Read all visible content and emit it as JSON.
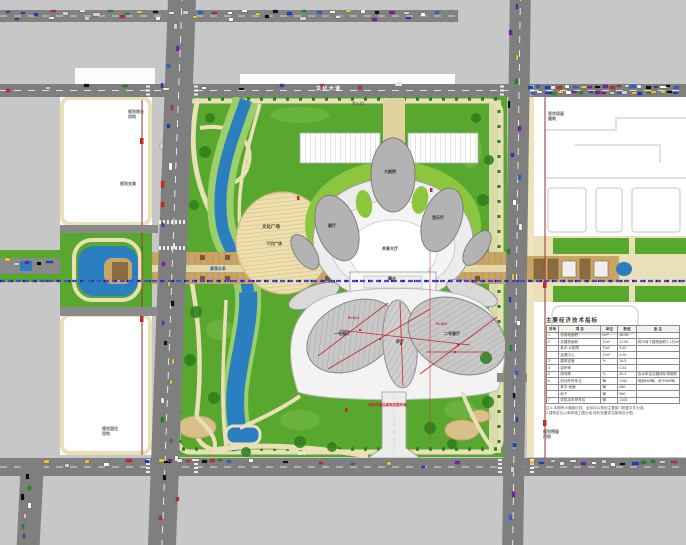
{
  "meta": {
    "drawing_type": "规划总平面图"
  },
  "colors": {
    "background_gray": "#c7c7c7",
    "road_gray": "#7f7f7f",
    "park_green": "#58a82f",
    "bank_green": "#9ccf6a",
    "water_blue": "#2b7fc0",
    "path_cream": "#e9e0b8",
    "axis_tan": "#c9a467",
    "building_gray": "#b3b3b3",
    "dimension_red": "#c62828",
    "boundary_brown": "#8b3a2a",
    "planning_line_purple": "#4747cf"
  },
  "labels": [
    {
      "id": "top-road-name",
      "text": "文 化 大 道",
      "x": 316,
      "y": 87,
      "size": 5,
      "color": "#ffffff"
    },
    {
      "id": "plot-nw-label",
      "text": "规划商业\n用地",
      "x": 128,
      "y": 110,
      "size": 4,
      "color": "#666666"
    },
    {
      "id": "road-branch-label",
      "text": "规划支路",
      "x": 120,
      "y": 182,
      "size": 4,
      "color": "#666666"
    },
    {
      "id": "plot-sw-label",
      "text": "规划居住\n用地",
      "x": 102,
      "y": 427,
      "size": 4,
      "color": "#666666"
    },
    {
      "id": "plot-ne-label",
      "text": "现状保留\n建筑",
      "x": 548,
      "y": 112,
      "size": 4,
      "color": "#666666"
    },
    {
      "id": "plot-se-label",
      "text": "规划预留\n用地",
      "x": 543,
      "y": 430,
      "size": 4,
      "color": "#666666"
    },
    {
      "id": "river-label",
      "text": "景观水系",
      "x": 210,
      "y": 267,
      "size": 4,
      "color": "#1a5fa8"
    },
    {
      "id": "plaza-label",
      "text": "文化广场",
      "x": 262,
      "y": 224,
      "size": 4.5,
      "color": "#44412e"
    },
    {
      "id": "sunken-plaza-label",
      "text": "下沉广场",
      "x": 266,
      "y": 242,
      "size": 4,
      "color": "#44412e"
    },
    {
      "id": "hall-exhibition-label",
      "text": "展厅",
      "x": 328,
      "y": 224,
      "size": 4,
      "color": "#333333"
    },
    {
      "id": "grand-theater-label",
      "text": "大剧院",
      "x": 384,
      "y": 170,
      "size": 4,
      "color": "#333333"
    },
    {
      "id": "concert-hall-label",
      "text": "音乐厅",
      "x": 432,
      "y": 216,
      "size": 4,
      "color": "#333333"
    },
    {
      "id": "shared-hall-label",
      "text": "共享大厅",
      "x": 382,
      "y": 247,
      "size": 4,
      "color": "#333333"
    },
    {
      "id": "stage-label",
      "text": "舞台",
      "x": 388,
      "y": 277,
      "size": 4,
      "color": "#333333"
    },
    {
      "id": "south-hall-1-label",
      "text": "一号展厅",
      "x": 334,
      "y": 332,
      "size": 4,
      "color": "#333333"
    },
    {
      "id": "south-hall-2-label",
      "text": "序厅",
      "x": 396,
      "y": 340,
      "size": 4,
      "color": "#333333"
    },
    {
      "id": "south-hall-3-label",
      "text": "二号展厅",
      "x": 444,
      "y": 332,
      "size": 4,
      "color": "#333333"
    },
    {
      "id": "dim-radius-1",
      "text": "R=52.0",
      "x": 348,
      "y": 316,
      "size": 3.5,
      "color": "#c62828"
    },
    {
      "id": "dim-radius-2",
      "text": "R=48.0",
      "x": 436,
      "y": 322,
      "size": 3.5,
      "color": "#c62828"
    },
    {
      "id": "fire-lane-note",
      "text": "消防环道沿建筑四周环通",
      "x": 368,
      "y": 403,
      "size": 3.5,
      "color": "#c62828"
    },
    {
      "id": "main-entrance-label",
      "text": "主入口",
      "x": 352,
      "y": 102,
      "size": 4,
      "color": "#555555"
    },
    {
      "id": "green-belt-dim",
      "text": "60.0",
      "x": 298,
      "y": 452,
      "size": 4,
      "color": "#ffffff"
    }
  ],
  "table": {
    "title": "主要经济技术指标",
    "headers": [
      "序号",
      "项 目",
      "单位",
      "数值",
      "备 注"
    ],
    "rows": [
      [
        "1",
        "总用地面积",
        "hm²",
        "38.56",
        ""
      ],
      [
        "2",
        "总建筑面积",
        "万m²",
        "12.80",
        "其中地下建筑面积2.1万m²"
      ],
      [
        "",
        "其中:大剧院",
        "万m²",
        "5.60",
        ""
      ],
      [
        "",
        "会展中心",
        "万m²",
        "4.90",
        ""
      ],
      [
        "3",
        "建筑密度",
        "%",
        "18.5",
        ""
      ],
      [
        "4",
        "容积率",
        "",
        "0.33",
        ""
      ],
      [
        "5",
        "绿地率",
        "%",
        "45.2",
        "含水体及沿路绿化带面积"
      ],
      [
        "6",
        "机动车停车位",
        "辆",
        "1260",
        "地面680辆、地下580辆"
      ],
      [
        "",
        "其中:地面",
        "辆",
        "680",
        ""
      ],
      [
        "",
        "地下",
        "辆",
        "580",
        ""
      ],
      [
        "7",
        "非机动车停车位",
        "辆",
        "2100",
        ""
      ]
    ],
    "notes": [
      "注:1.本图所示道路红线、坐标均以规划主管部门批复文件为准。",
      "2.建筑定位以单体施工图为准,绿化布置详见景观设计图。"
    ]
  },
  "traffic": {
    "palette": [
      "#c62828",
      "#1a3fbf",
      "#ffffff",
      "#101010",
      "#e8e8e8",
      "#2f5fd0",
      "#f2c41d",
      "#1f8a1f",
      "#d0d0d0",
      "#7b1fa2"
    ],
    "strips": [
      {
        "id": "top-road-lane-a",
        "dir": "h",
        "x": 4,
        "y": 11.5,
        "len": 444,
        "count": 30,
        "spread": 2
      },
      {
        "id": "top-road-lane-b",
        "dir": "h",
        "x": 12,
        "y": 16.5,
        "len": 430,
        "count": 12,
        "spread": 2
      },
      {
        "id": "main-road-west",
        "dir": "h",
        "x": 4,
        "y": 87,
        "len": 430,
        "count": 11,
        "spread": 4
      },
      {
        "id": "main-road-east-parked-a",
        "dir": "h",
        "x": 528,
        "y": 85.5,
        "len": 152,
        "count": 21,
        "spread": 1
      },
      {
        "id": "main-road-east-parked-b",
        "dir": "h",
        "x": 528,
        "y": 91.5,
        "len": 152,
        "count": 21,
        "spread": 1
      },
      {
        "id": "left-road",
        "dir": "v",
        "x": 168,
        "y": 24,
        "len": 510,
        "count": 26,
        "spread": 9
      },
      {
        "id": "right-road",
        "dir": "v",
        "x": 513,
        "y": 4,
        "len": 535,
        "count": 22,
        "spread": 6
      },
      {
        "id": "west-axis-road",
        "dir": "h",
        "x": 3,
        "y": 261,
        "len": 52,
        "count": 5,
        "spread": 3
      },
      {
        "id": "bottom-road-west",
        "dir": "h",
        "x": 44,
        "y": 461,
        "len": 140,
        "count": 7,
        "spread": 4
      },
      {
        "id": "bottom-parked-row",
        "dir": "h",
        "x": 158,
        "y": 459.5,
        "len": 76,
        "count": 9,
        "spread": 1
      },
      {
        "id": "bottom-road-mid",
        "dir": "h",
        "x": 248,
        "y": 463,
        "len": 240,
        "count": 7,
        "spread": 4
      },
      {
        "id": "bottom-road-east",
        "dir": "h",
        "x": 528,
        "y": 461.5,
        "len": 152,
        "count": 15,
        "spread": 2
      },
      {
        "id": "sw-branch-road",
        "dir": "v",
        "x": 25,
        "y": 474,
        "len": 68,
        "count": 7,
        "spread": 4
      }
    ]
  }
}
